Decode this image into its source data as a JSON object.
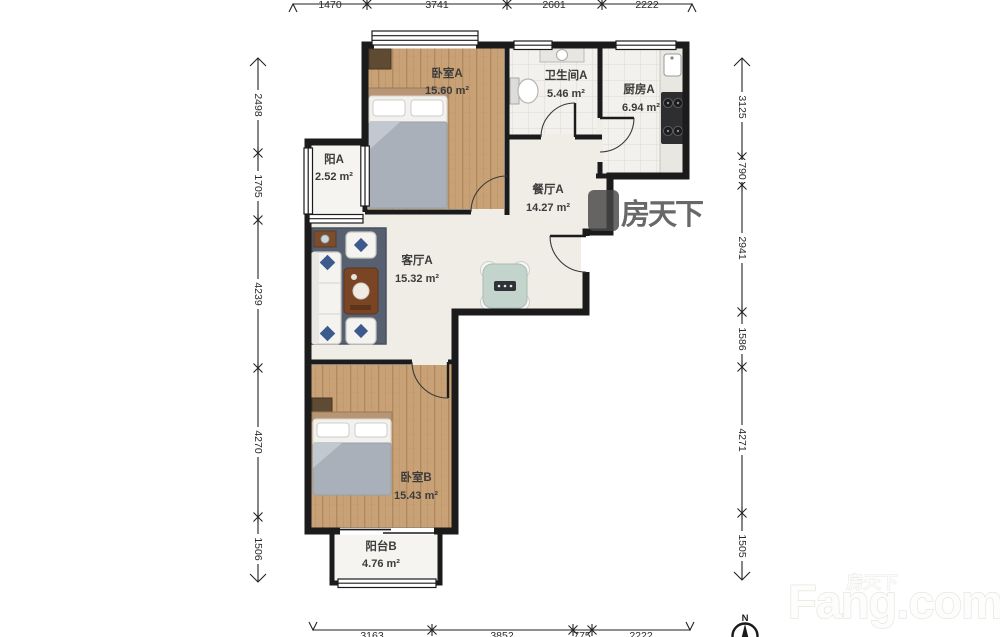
{
  "meta": {
    "title": "户型图"
  },
  "rooms": [
    {
      "name": "卧室A",
      "area": "15.60 m²"
    },
    {
      "name": "卫生间A",
      "area": "5.46 m²"
    },
    {
      "name": "厨房A",
      "area": "6.94 m²"
    },
    {
      "name": "阳A",
      "area": "2.52 m²"
    },
    {
      "name": "餐厅A",
      "area": "14.27 m²"
    },
    {
      "name": "客厅A",
      "area": "15.32 m²"
    },
    {
      "name": "卧室B",
      "area": "15.43 m²"
    },
    {
      "name": "阳台B",
      "area": "4.76 m²"
    }
  ],
  "dimensions": {
    "top": [
      "1470",
      "3741",
      "2601",
      "2222"
    ],
    "bottom": [
      "3163",
      "3852",
      "775",
      "2222"
    ],
    "left": [
      "2498",
      "1705",
      "4239",
      "4270",
      "1506"
    ],
    "right": [
      "3125",
      "790",
      "2941",
      "1586",
      "4271",
      "1505"
    ]
  },
  "compass": {
    "label": "N"
  },
  "watermark": {
    "cn": "房天下",
    "en": "Fang.com"
  },
  "colors": {
    "wall": "#1b1b1b",
    "wood_floor": "#c9a176",
    "tile_floor": "#f3f1ed",
    "hall_floor": "#f0ede7",
    "rug": "#566070",
    "accent_pillow": "#3d5a8f"
  }
}
